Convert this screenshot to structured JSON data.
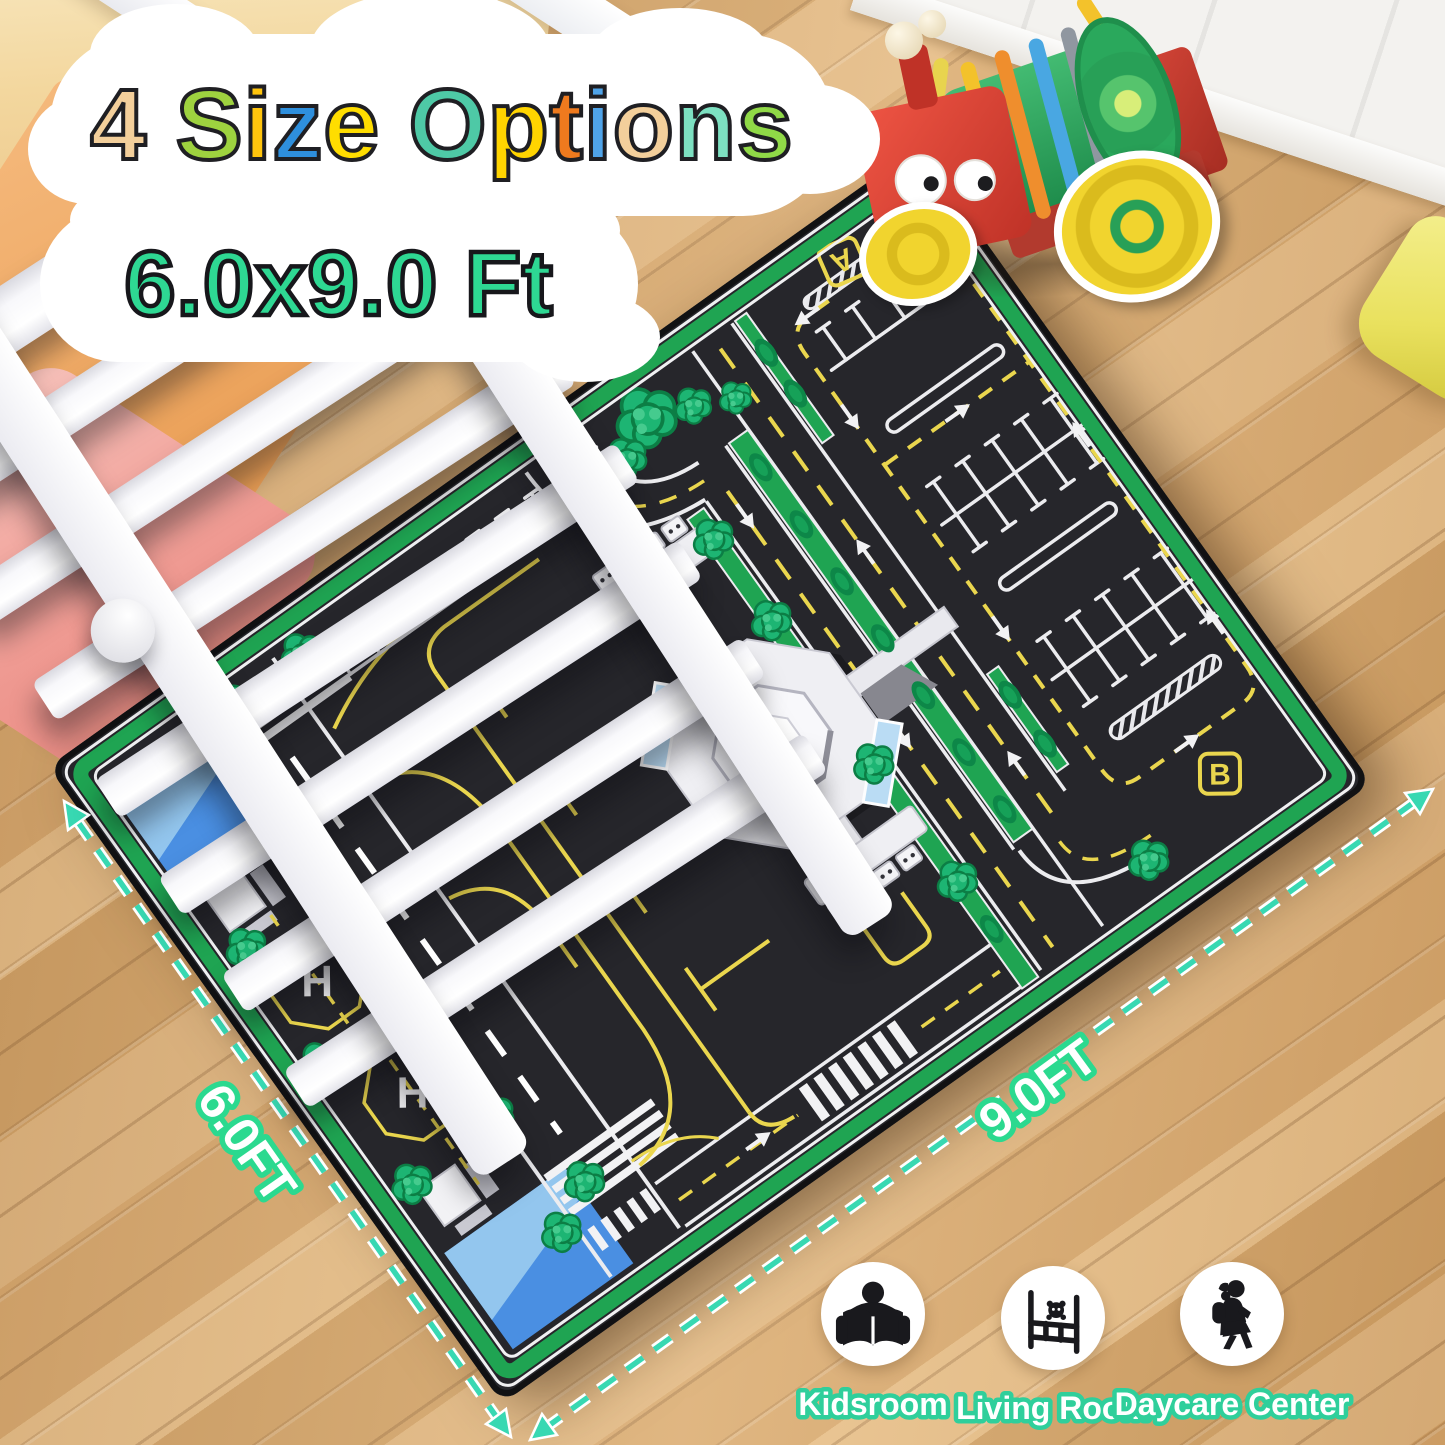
{
  "title": {
    "letters": [
      {
        "ch": "4",
        "color": "#f3cf9b"
      },
      {
        "ch": " "
      },
      {
        "ch": "S",
        "color": "#9ed23f"
      },
      {
        "ch": "i",
        "color": "#ffc40d"
      },
      {
        "ch": "z",
        "color": "#2e8fdd"
      },
      {
        "ch": "e",
        "color": "#ffdd00"
      },
      {
        "ch": " "
      },
      {
        "ch": "O",
        "color": "#4ec9a6"
      },
      {
        "ch": "p",
        "color": "#ffd400"
      },
      {
        "ch": "t",
        "color": "#ef7a1e"
      },
      {
        "ch": "i",
        "color": "#4fa3e8"
      },
      {
        "ch": "o",
        "color": "#f3cf9b"
      },
      {
        "ch": "n",
        "color": "#7de0c1"
      },
      {
        "ch": "s",
        "color": "#90d947"
      }
    ],
    "size_text": "6.0x9.0 Ft",
    "size_color": "#2ed893",
    "outline_color": "#1f1f23"
  },
  "measurements": {
    "short_side": "6.0FT",
    "long_side": "9.0FT",
    "line_color": "#38d8b2",
    "label_fill": "#ffffff",
    "label_outline": "#2bd98f"
  },
  "rug": {
    "gate_a": "A",
    "gate_b": "B",
    "helipad": "H",
    "colors": {
      "asphalt": "#26262b",
      "border_green": "#1fa452",
      "marking_yellow": "#ead64e",
      "marking_white": "#ececef",
      "pool_blue": "#4a8fe2",
      "pool_blue_light": "#93c6ee",
      "tree_green": "#1db573"
    }
  },
  "rooms": [
    {
      "label": "Kidsroom",
      "icon": "reading-child-icon"
    },
    {
      "label": "Living Room",
      "icon": "toddler-bed-icon"
    },
    {
      "label": "Daycare Center",
      "icon": "walking-girl-icon"
    }
  ]
}
